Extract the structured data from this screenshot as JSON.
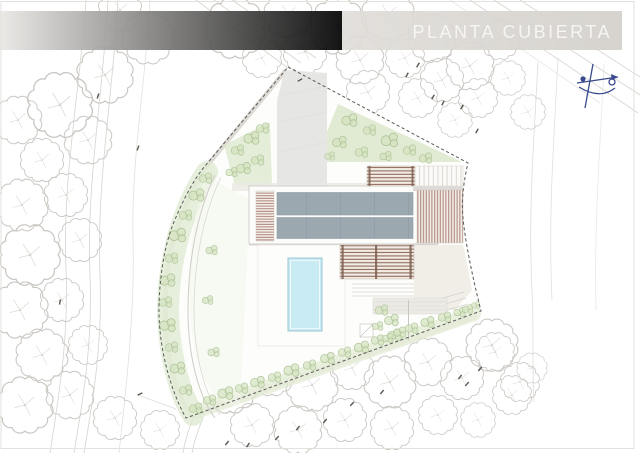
{
  "sheet": {
    "title": "PLANTA CUBIERTA"
  },
  "icons": {
    "north_arrow": "north-arrow-icon"
  },
  "colors": {
    "paper": "#ffffff",
    "title_band_left": "#eae8e5",
    "title_band_right": "#d3d0cb",
    "title_text": "#f6f5f3",
    "roof_panel": "#9ca8b0",
    "roof_seam": "#919da6",
    "louver_line": "#a3786c",
    "pergola_slat": "#8f6c5c",
    "pergola_post": "#7c5f50",
    "pool_water": "#c9ebf3",
    "pool_edge": "#9cc6d3",
    "vegetation_fill": "#d3e3bf",
    "vegetation_line": "#a9c193",
    "lawn_band": "#dfe9d2",
    "driveway": "#e6e6e4",
    "terrace": "#eceae5",
    "boundary_dash": "#5b5b59",
    "tree_outline": "#cbc8c4",
    "road_line": "#d6d3cf",
    "north_arrow": "#39498e",
    "spot_mark": "#5a554f"
  }
}
